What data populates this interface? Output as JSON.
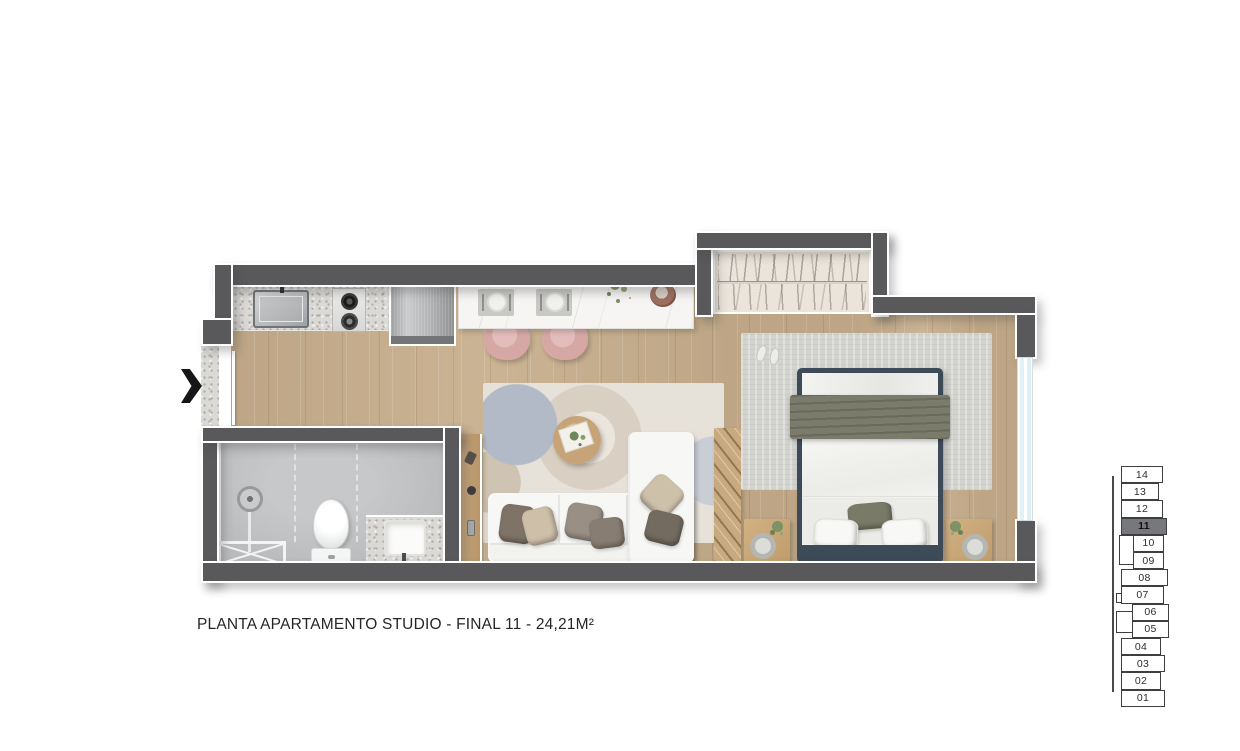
{
  "title": {
    "text": "PLANTA APARTAMENTO STUDIO - FINAL 11 - 24,21M²"
  },
  "entrance": {
    "direction": "right"
  },
  "colors": {
    "wall": "#59595b",
    "wood_floor": "#c7ae8c",
    "bathroom_floor": "#babbbd",
    "granite_counter": "#dbd9d5",
    "marble_counter": "#f6f5f3",
    "window_glass": "#ddeef5",
    "stool_pink": "#d5a8a6",
    "bed_frame_navy": "#3d4a57",
    "throw_olive": "#7b7b6c",
    "closet_fill": "#eae4db",
    "selected_floor": "#77787b"
  },
  "floor_selector": {
    "selected": "11",
    "floors": [
      "14",
      "13",
      "12",
      "11",
      "10",
      "09",
      "08",
      "07",
      "06",
      "05",
      "04",
      "03",
      "02",
      "01"
    ]
  }
}
